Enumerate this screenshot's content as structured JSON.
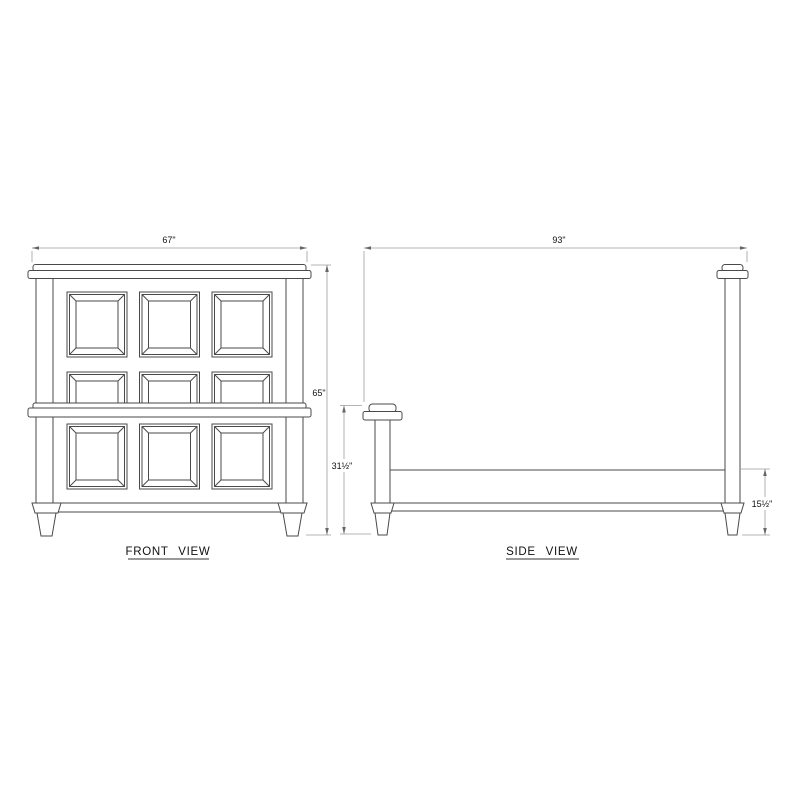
{
  "drawing": {
    "views": {
      "front": {
        "label": "FRONT VIEW",
        "width_dim": "67\"",
        "height_dim": "65\""
      },
      "side": {
        "label": "SIDE VIEW",
        "length_dim": "93\"",
        "post_height_dim": "31½\"",
        "rail_height_dim": "15½\""
      }
    },
    "colors": {
      "background": "#ffffff",
      "object_line": "#4a4a4a",
      "dimension_line": "#9c9c9c",
      "arrow": "#666666",
      "text": "#111111"
    }
  }
}
